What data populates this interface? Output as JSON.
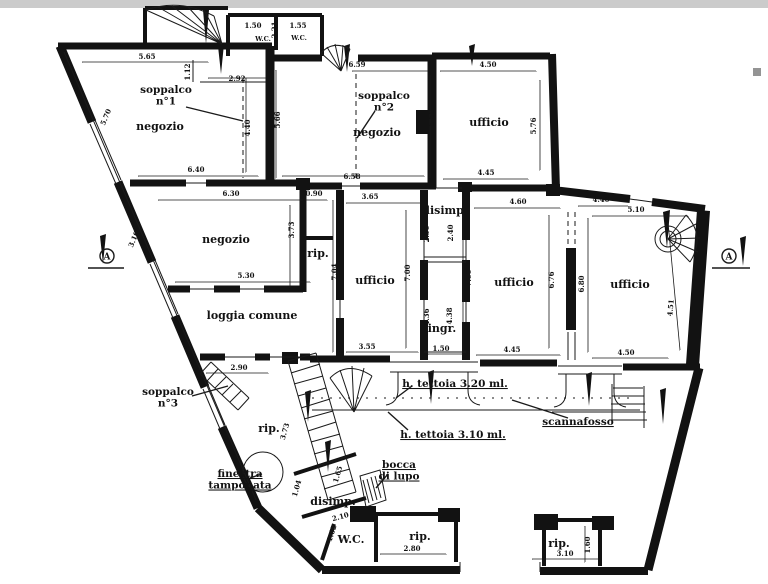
{
  "drawing": {
    "type": "architectural-floor-plan",
    "paper_color": "#ffffff",
    "ink_color": "#121212",
    "scan_edge_color": "#cbcbcb"
  },
  "rooms": [
    {
      "id": "negozio-1",
      "label": "negozio",
      "x": 160,
      "y": 130
    },
    {
      "id": "negozio-2",
      "label": "negozio",
      "x": 377,
      "y": 136
    },
    {
      "id": "negozio-3",
      "label": "negozio",
      "x": 226,
      "y": 243
    },
    {
      "id": "ufficio-1",
      "label": "ufficio",
      "x": 489,
      "y": 126
    },
    {
      "id": "ufficio-2",
      "label": "ufficio",
      "x": 375,
      "y": 284
    },
    {
      "id": "ufficio-3",
      "label": "ufficio",
      "x": 514,
      "y": 286
    },
    {
      "id": "ufficio-4",
      "label": "ufficio",
      "x": 630,
      "y": 288
    },
    {
      "id": "loggia-comune",
      "label": "loggia comune",
      "x": 252,
      "y": 319
    },
    {
      "id": "rip-1",
      "label": "rip.",
      "x": 318,
      "y": 257
    },
    {
      "id": "rip-2",
      "label": "rip.",
      "x": 269,
      "y": 432
    },
    {
      "id": "rip-3",
      "label": "rip.",
      "x": 420,
      "y": 540
    },
    {
      "id": "rip-4",
      "label": "rip.",
      "x": 559,
      "y": 547
    },
    {
      "id": "disimp-1",
      "label": "disimp.",
      "x": 445,
      "y": 214
    },
    {
      "id": "disimp-2",
      "label": "disimp.",
      "x": 333,
      "y": 505
    },
    {
      "id": "ingr",
      "label": "ingr.",
      "x": 442,
      "y": 332
    },
    {
      "id": "wc-1",
      "label": "W.C.",
      "x": 263,
      "y": 41,
      "small": true
    },
    {
      "id": "wc-2",
      "label": "W.C.",
      "x": 299,
      "y": 40,
      "small": true
    },
    {
      "id": "wc-3",
      "label": "W.C.",
      "x": 351,
      "y": 543
    }
  ],
  "annotations": [
    {
      "id": "soppalco-1",
      "lines": [
        "soppalco",
        "n°1"
      ],
      "x": 166,
      "y": 93,
      "underline": false
    },
    {
      "id": "soppalco-2",
      "lines": [
        "soppalco",
        "n°2"
      ],
      "x": 384,
      "y": 99,
      "underline": false
    },
    {
      "id": "soppalco-3",
      "lines": [
        "soppalco",
        "n°3"
      ],
      "x": 168,
      "y": 395,
      "underline": false
    },
    {
      "id": "finestra-tamponata",
      "lines": [
        "finestra",
        "tamponata"
      ],
      "x": 240,
      "y": 477,
      "underline": true
    },
    {
      "id": "bocca-di-lupo",
      "lines": [
        "bocca",
        "di lupo"
      ],
      "x": 399,
      "y": 468,
      "underline": true
    },
    {
      "id": "h-tettoia-320",
      "lines": [
        "h. tettoia 3.20 ml."
      ],
      "x": 455,
      "y": 387,
      "underline": true
    },
    {
      "id": "h-tettoia-310",
      "lines": [
        "h. tettoia 3.10 ml."
      ],
      "x": 453,
      "y": 438,
      "underline": true
    },
    {
      "id": "scannafosso",
      "lines": [
        "scannafosso"
      ],
      "x": 578,
      "y": 425,
      "underline": true
    }
  ],
  "dimensions": [
    {
      "text": "5.65",
      "x": 147,
      "y": 59,
      "rot": 0
    },
    {
      "text": "1.12",
      "x": 190,
      "y": 72,
      "rot": -90
    },
    {
      "text": "2.92",
      "x": 237,
      "y": 81,
      "rot": 0
    },
    {
      "text": "1.50",
      "x": 253,
      "y": 28,
      "rot": 0
    },
    {
      "text": "2.21",
      "x": 277,
      "y": 30,
      "rot": -90
    },
    {
      "text": "1.55",
      "x": 298,
      "y": 28,
      "rot": 0
    },
    {
      "text": "6.59",
      "x": 357,
      "y": 67,
      "rot": 0
    },
    {
      "text": "5.70",
      "x": 108,
      "y": 118,
      "rot": -67
    },
    {
      "text": "4.40",
      "x": 250,
      "y": 128,
      "rot": -90
    },
    {
      "text": "5.66",
      "x": 280,
      "y": 120,
      "rot": -90
    },
    {
      "text": "5.60",
      "x": 434,
      "y": 118,
      "rot": -90
    },
    {
      "text": "4.50",
      "x": 488,
      "y": 67,
      "rot": 0
    },
    {
      "text": "5.76",
      "x": 536,
      "y": 126,
      "rot": -90
    },
    {
      "text": "6.40",
      "x": 196,
      "y": 172,
      "rot": 0
    },
    {
      "text": "6.58",
      "x": 352,
      "y": 179,
      "rot": 0
    },
    {
      "text": "4.45",
      "x": 486,
      "y": 175,
      "rot": 0
    },
    {
      "text": "6.30",
      "x": 231,
      "y": 196,
      "rot": 0
    },
    {
      "text": "0.90",
      "x": 314,
      "y": 196,
      "rot": 0
    },
    {
      "text": "3.65",
      "x": 370,
      "y": 199,
      "rot": 0
    },
    {
      "text": "4.60",
      "x": 518,
      "y": 204,
      "rot": 0
    },
    {
      "text": "4.40",
      "x": 601,
      "y": 202,
      "rot": 0
    },
    {
      "text": "5.10",
      "x": 636,
      "y": 212,
      "rot": 0
    },
    {
      "text": "3.10",
      "x": 136,
      "y": 240,
      "rot": -67
    },
    {
      "text": "3.73",
      "x": 294,
      "y": 230,
      "rot": -90
    },
    {
      "text": "7.04",
      "x": 337,
      "y": 272,
      "rot": -90
    },
    {
      "text": "7.00",
      "x": 410,
      "y": 273,
      "rot": -90
    },
    {
      "text": "2.50",
      "x": 429,
      "y": 234,
      "rot": -90
    },
    {
      "text": "2.40",
      "x": 453,
      "y": 233,
      "rot": -90
    },
    {
      "text": "7.00",
      "x": 471,
      "y": 278,
      "rot": -90
    },
    {
      "text": "6.76",
      "x": 554,
      "y": 280,
      "rot": -90
    },
    {
      "text": "6.80",
      "x": 584,
      "y": 284,
      "rot": -90
    },
    {
      "text": "4.51",
      "x": 673,
      "y": 308,
      "rot": -85
    },
    {
      "text": "5.30",
      "x": 246,
      "y": 278,
      "rot": 0
    },
    {
      "text": "4.36",
      "x": 429,
      "y": 317,
      "rot": -90
    },
    {
      "text": "4.38",
      "x": 452,
      "y": 316,
      "rot": -90
    },
    {
      "text": "3.55",
      "x": 367,
      "y": 349,
      "rot": 0
    },
    {
      "text": "1.50",
      "x": 441,
      "y": 351,
      "rot": 0
    },
    {
      "text": "4.45",
      "x": 512,
      "y": 352,
      "rot": 0
    },
    {
      "text": "4.50",
      "x": 626,
      "y": 355,
      "rot": 0
    },
    {
      "text": "2.90",
      "x": 239,
      "y": 370,
      "rot": 0
    },
    {
      "text": "3.73",
      "x": 287,
      "y": 432,
      "rot": -74
    },
    {
      "text": "1.65",
      "x": 340,
      "y": 475,
      "rot": -74
    },
    {
      "text": "1.04",
      "x": 299,
      "y": 489,
      "rot": -74
    },
    {
      "text": "2.10",
      "x": 341,
      "y": 519,
      "rot": -15
    },
    {
      "text": "1.62",
      "x": 334,
      "y": 534,
      "rot": -72
    },
    {
      "text": "2.80",
      "x": 412,
      "y": 551,
      "rot": 0
    },
    {
      "text": "3.10",
      "x": 565,
      "y": 556,
      "rot": 0
    },
    {
      "text": "1.60",
      "x": 590,
      "y": 545,
      "rot": -90
    }
  ],
  "section_markers": [
    {
      "letter": "A",
      "side": "left"
    },
    {
      "letter": "A",
      "side": "right"
    }
  ]
}
